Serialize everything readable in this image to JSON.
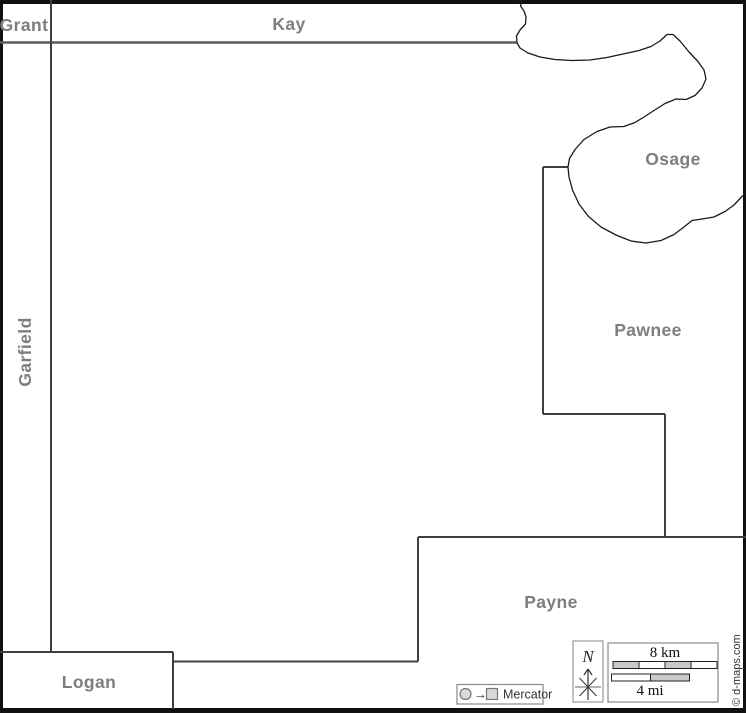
{
  "map": {
    "title": "Blank county outline map",
    "counties": [
      {
        "id": "grant",
        "name": "Grant"
      },
      {
        "id": "kay",
        "name": "Kay"
      },
      {
        "id": "osage",
        "name": "Osage"
      },
      {
        "id": "pawnee",
        "name": "Pawnee"
      },
      {
        "id": "payne",
        "name": "Payne"
      },
      {
        "id": "logan",
        "name": "Logan"
      },
      {
        "id": "garfield",
        "name": "Garfield"
      }
    ]
  },
  "legend": {
    "projection_label": "Mercator",
    "arrow_glyph": "→"
  },
  "compass": {
    "north_label": "N"
  },
  "scale": {
    "km_label": "8 km",
    "mi_label": "4 mi"
  },
  "credit": "© d-maps.com",
  "colors": {
    "label_gray": "#7e7e7e",
    "boundary": "#3f3f3f",
    "river": "#1a1a1a",
    "border_black": "#111111",
    "scale_fill": "#c9c9c9",
    "legend_fill": "#d9d9d9",
    "legend_stroke": "#8a8a8a"
  }
}
